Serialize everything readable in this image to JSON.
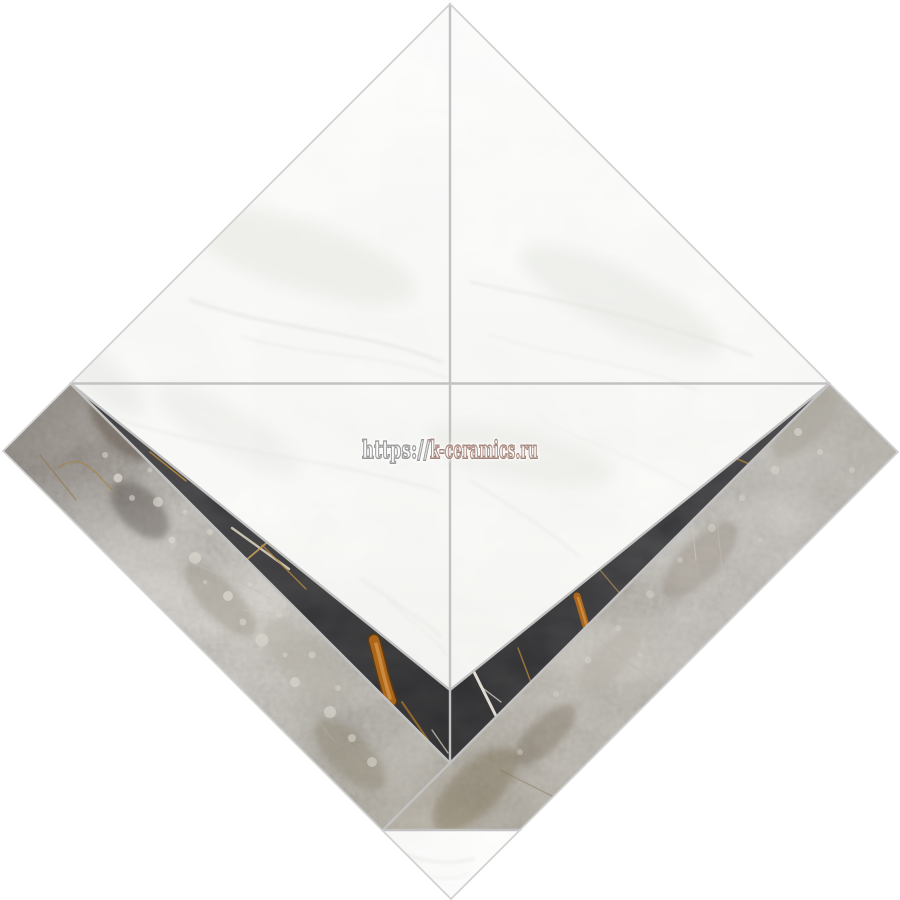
{
  "page": {
    "background_color": "#ffffff",
    "content_type": "product photo of a marble mosaic tile, diamond orientation"
  },
  "product_image": {
    "description": "Square chevron mosaic tile of mixed marbles, displayed rotated 45 degrees (diamond)",
    "materials": {
      "white_marble": "#f4f4f1",
      "grey_marble": "#87827a",
      "black_marble": "#0d0c0f",
      "gold_vein": "#b06a1e",
      "white_vein": "#e9e5da",
      "grout": "#c2c2c2",
      "outer_edge": "#d2d2d2"
    },
    "pieces": [
      {
        "id": "white-field-top-left",
        "material": "white marble"
      },
      {
        "id": "white-field-top-right",
        "material": "white marble"
      },
      {
        "id": "white-field-bottom-left",
        "material": "white marble"
      },
      {
        "id": "white-field-bottom-right",
        "material": "white marble"
      },
      {
        "id": "black-wedge-left",
        "material": "black marble with gold and white veins"
      },
      {
        "id": "black-wedge-right",
        "material": "black marble with gold and white veins"
      },
      {
        "id": "grey-band-left",
        "material": "grey brecciated marble"
      },
      {
        "id": "grey-band-right",
        "material": "grey marble"
      },
      {
        "id": "white-tip-bottom",
        "material": "white marble"
      }
    ]
  },
  "watermark": {
    "prefix": "https://",
    "domain": "k-ceramics.ru",
    "full_text": "https://k-ceramics.ru",
    "prefix_color": "#8d8d8d",
    "domain_color": "#99756a",
    "style": "hollow outlined bold lettering"
  }
}
